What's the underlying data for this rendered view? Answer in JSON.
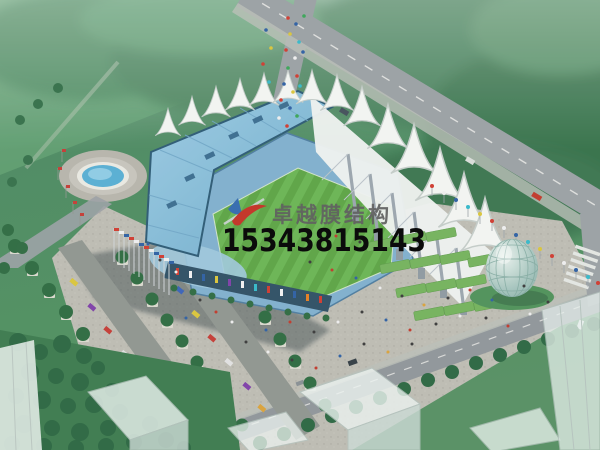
{
  "scene": {
    "type": "aerial-architectural-rendering",
    "subject": "stadium-with-tensile-membrane-roof",
    "elements": [
      "forest-background",
      "main-road",
      "north-spur-road",
      "southeast-road",
      "crosswalk",
      "plaza",
      "stadium-bowl",
      "football-pitch",
      "west-roof-slab",
      "membrane-tent-crown",
      "east-membrane-roof",
      "support-masts",
      "green-terraces",
      "fountain-plaza",
      "glass-dome-pavilion",
      "tree-lined-parking-avenue",
      "flag-rows",
      "city-blocks",
      "stadium-shadow"
    ]
  },
  "watermark": {
    "company_name": "卓越膜结构",
    "phone": "15343815143",
    "name_color": "#616161",
    "phone_color": "#0b0b0b",
    "logo_red": "#c4392c",
    "logo_blue": "#3a6fb0"
  },
  "palette": {
    "forest_green": "#417e56",
    "field_green": "#63a173",
    "lawn_green": "#4f8f5f",
    "road_gray": "#9aa0a4",
    "plaza_gray": "#bcbbb2",
    "stadium_roof_blue": "#8cc0dc",
    "stand_blue": "#7fafcd",
    "facade_teal": "#2f5065",
    "pitch_green": "#5ca445",
    "pitch_stripe_green": "#6ab453",
    "membrane_white": "#f2f4f1",
    "mast_gray": "#9aa5ad",
    "terrace_green": "#74b25c",
    "water_blue": "#57aed2",
    "dome_teal": "#8fb4ad",
    "shadow": "#2c3b40"
  }
}
